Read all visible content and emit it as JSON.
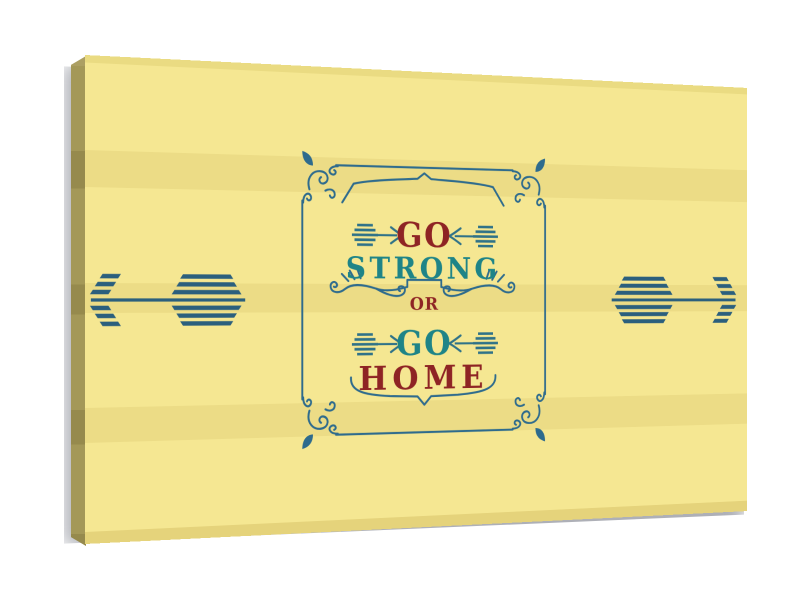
{
  "artwork": {
    "phrase": "GO STRONG OR GO HOME",
    "words": [
      {
        "id": "go-1",
        "text": "GO"
      },
      {
        "id": "strong",
        "text": "STRONG"
      },
      {
        "id": "or",
        "text": "OR"
      },
      {
        "id": "go-2",
        "text": "GO"
      },
      {
        "id": "home",
        "text": "HOME"
      }
    ],
    "icons": [
      "big-arrow-left-icon",
      "big-arrow-right-icon",
      "mini-arrow-icon",
      "ornate-border-frame",
      "corner-flourish-icon",
      "shield-crest-ornament",
      "swirl-flourish-ornament",
      "banner-bracket-ornament"
    ]
  },
  "colors": {
    "canvas_base": "#f5e792",
    "canvas_stripe": "#ecdc86",
    "canvas_bevel_top": "#eadb82",
    "canvas_bevel_bottom": "#e5d37b",
    "canvas_side": "#a49858",
    "canvas_side_light": "#ac9f63",
    "canvas_side_dark": "#968a4d",
    "frame_blue": "#2e6b8d",
    "arrow_blue": "#2b5f7d",
    "small_arrow_teal": "#2f7288",
    "teal_text": "#1e8487",
    "maroon_text": "#8e2424",
    "shadow_gray": "rgba(108,112,124,0.55)",
    "background_white": "#ffffff"
  }
}
